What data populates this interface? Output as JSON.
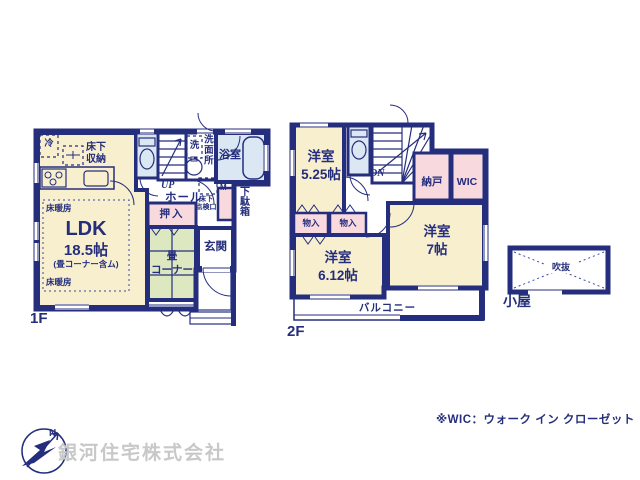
{
  "colors": {
    "wall": "#252e7d",
    "room_cream": "#f8efcf",
    "closet_pink": "#f8d9de",
    "wet_blue": "#dbe7f3",
    "tatami_green": "#dde8c0",
    "company_gray": "#c8c8c8"
  },
  "f1": {
    "floor": "1F",
    "ldk": "LDK",
    "ldk_size": "18.5帖",
    "ldk_note": "(畳コーナー含ム)",
    "yukadanbo": "床暖房",
    "reizo": "冷",
    "shuno": "床下\n収納",
    "sen": "洗",
    "senmenjo": "洗面所",
    "yokushitsu": "浴室",
    "up": "UP",
    "hall": "ホール",
    "meter": "M",
    "getabako": "下駄箱",
    "tenkenko": "床下\n点検口",
    "oshiire": "押入",
    "genkan": "玄関",
    "tatami": "畳\nコーナー"
  },
  "f2": {
    "floor": "2F",
    "room525": "洋室\n5.25帖",
    "dn": "DN",
    "nando": "納戸",
    "wic": "WIC",
    "monoire": "物入",
    "room612": "洋室\n6.12帖",
    "room7": "洋室\n7帖",
    "balcony": "バルコニー"
  },
  "annex": {
    "fukinuke": "吹抜",
    "koya": "小屋"
  },
  "footnote": "※WIC：ウォーク イン クローゼット",
  "company": "銀河住宅株式会社",
  "logo_n": "N"
}
